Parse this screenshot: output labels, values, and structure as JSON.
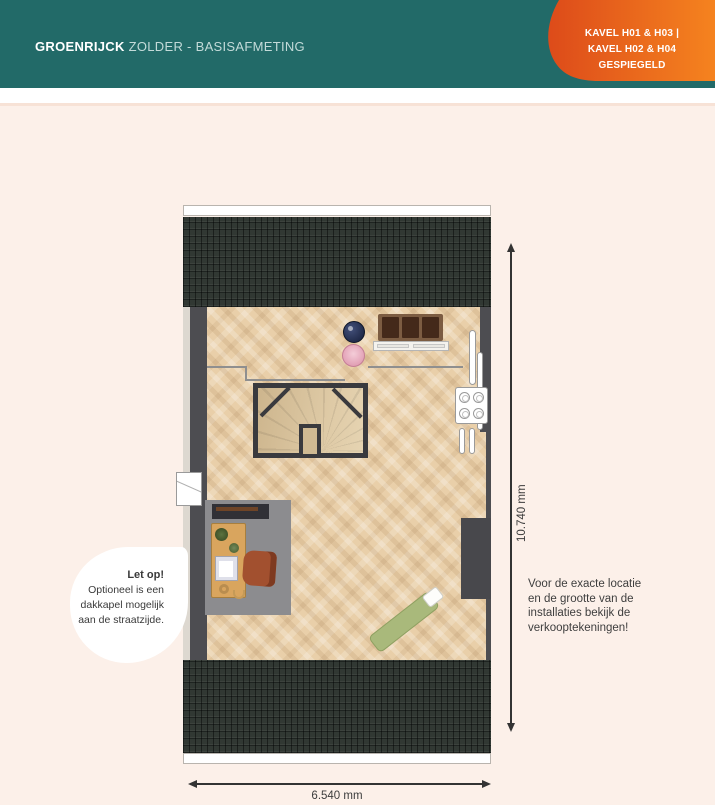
{
  "header": {
    "title_bold": "GROENRIJCK",
    "title_rest": "ZOLDER - BASISAFMETING",
    "badge_line1": "KAVEL H01 & H03 |",
    "badge_line2": "KAVEL H02 & H04 GESPIEGELD"
  },
  "dimensions": {
    "width_label": "6.540 mm",
    "height_label": "10.740 mm"
  },
  "callout": {
    "title": "Let op!",
    "lines": [
      "Optioneel is een",
      "dakkapel mogelijk",
      "aan de straatzijde."
    ]
  },
  "note": {
    "lines": [
      "Voor de exacte locatie",
      "en de grootte van de",
      "installaties bekijk de",
      "verkooptekeningen!"
    ]
  },
  "colors": {
    "header_teal": "#226a68",
    "badge_orange_start": "#dd4b1a",
    "badge_orange_end": "#f5831f",
    "page_peach": "#fcf0e9",
    "roof_dark": "#313833",
    "floor_wood": "#e9cfa9",
    "wall_gray": "#4d4d51"
  }
}
